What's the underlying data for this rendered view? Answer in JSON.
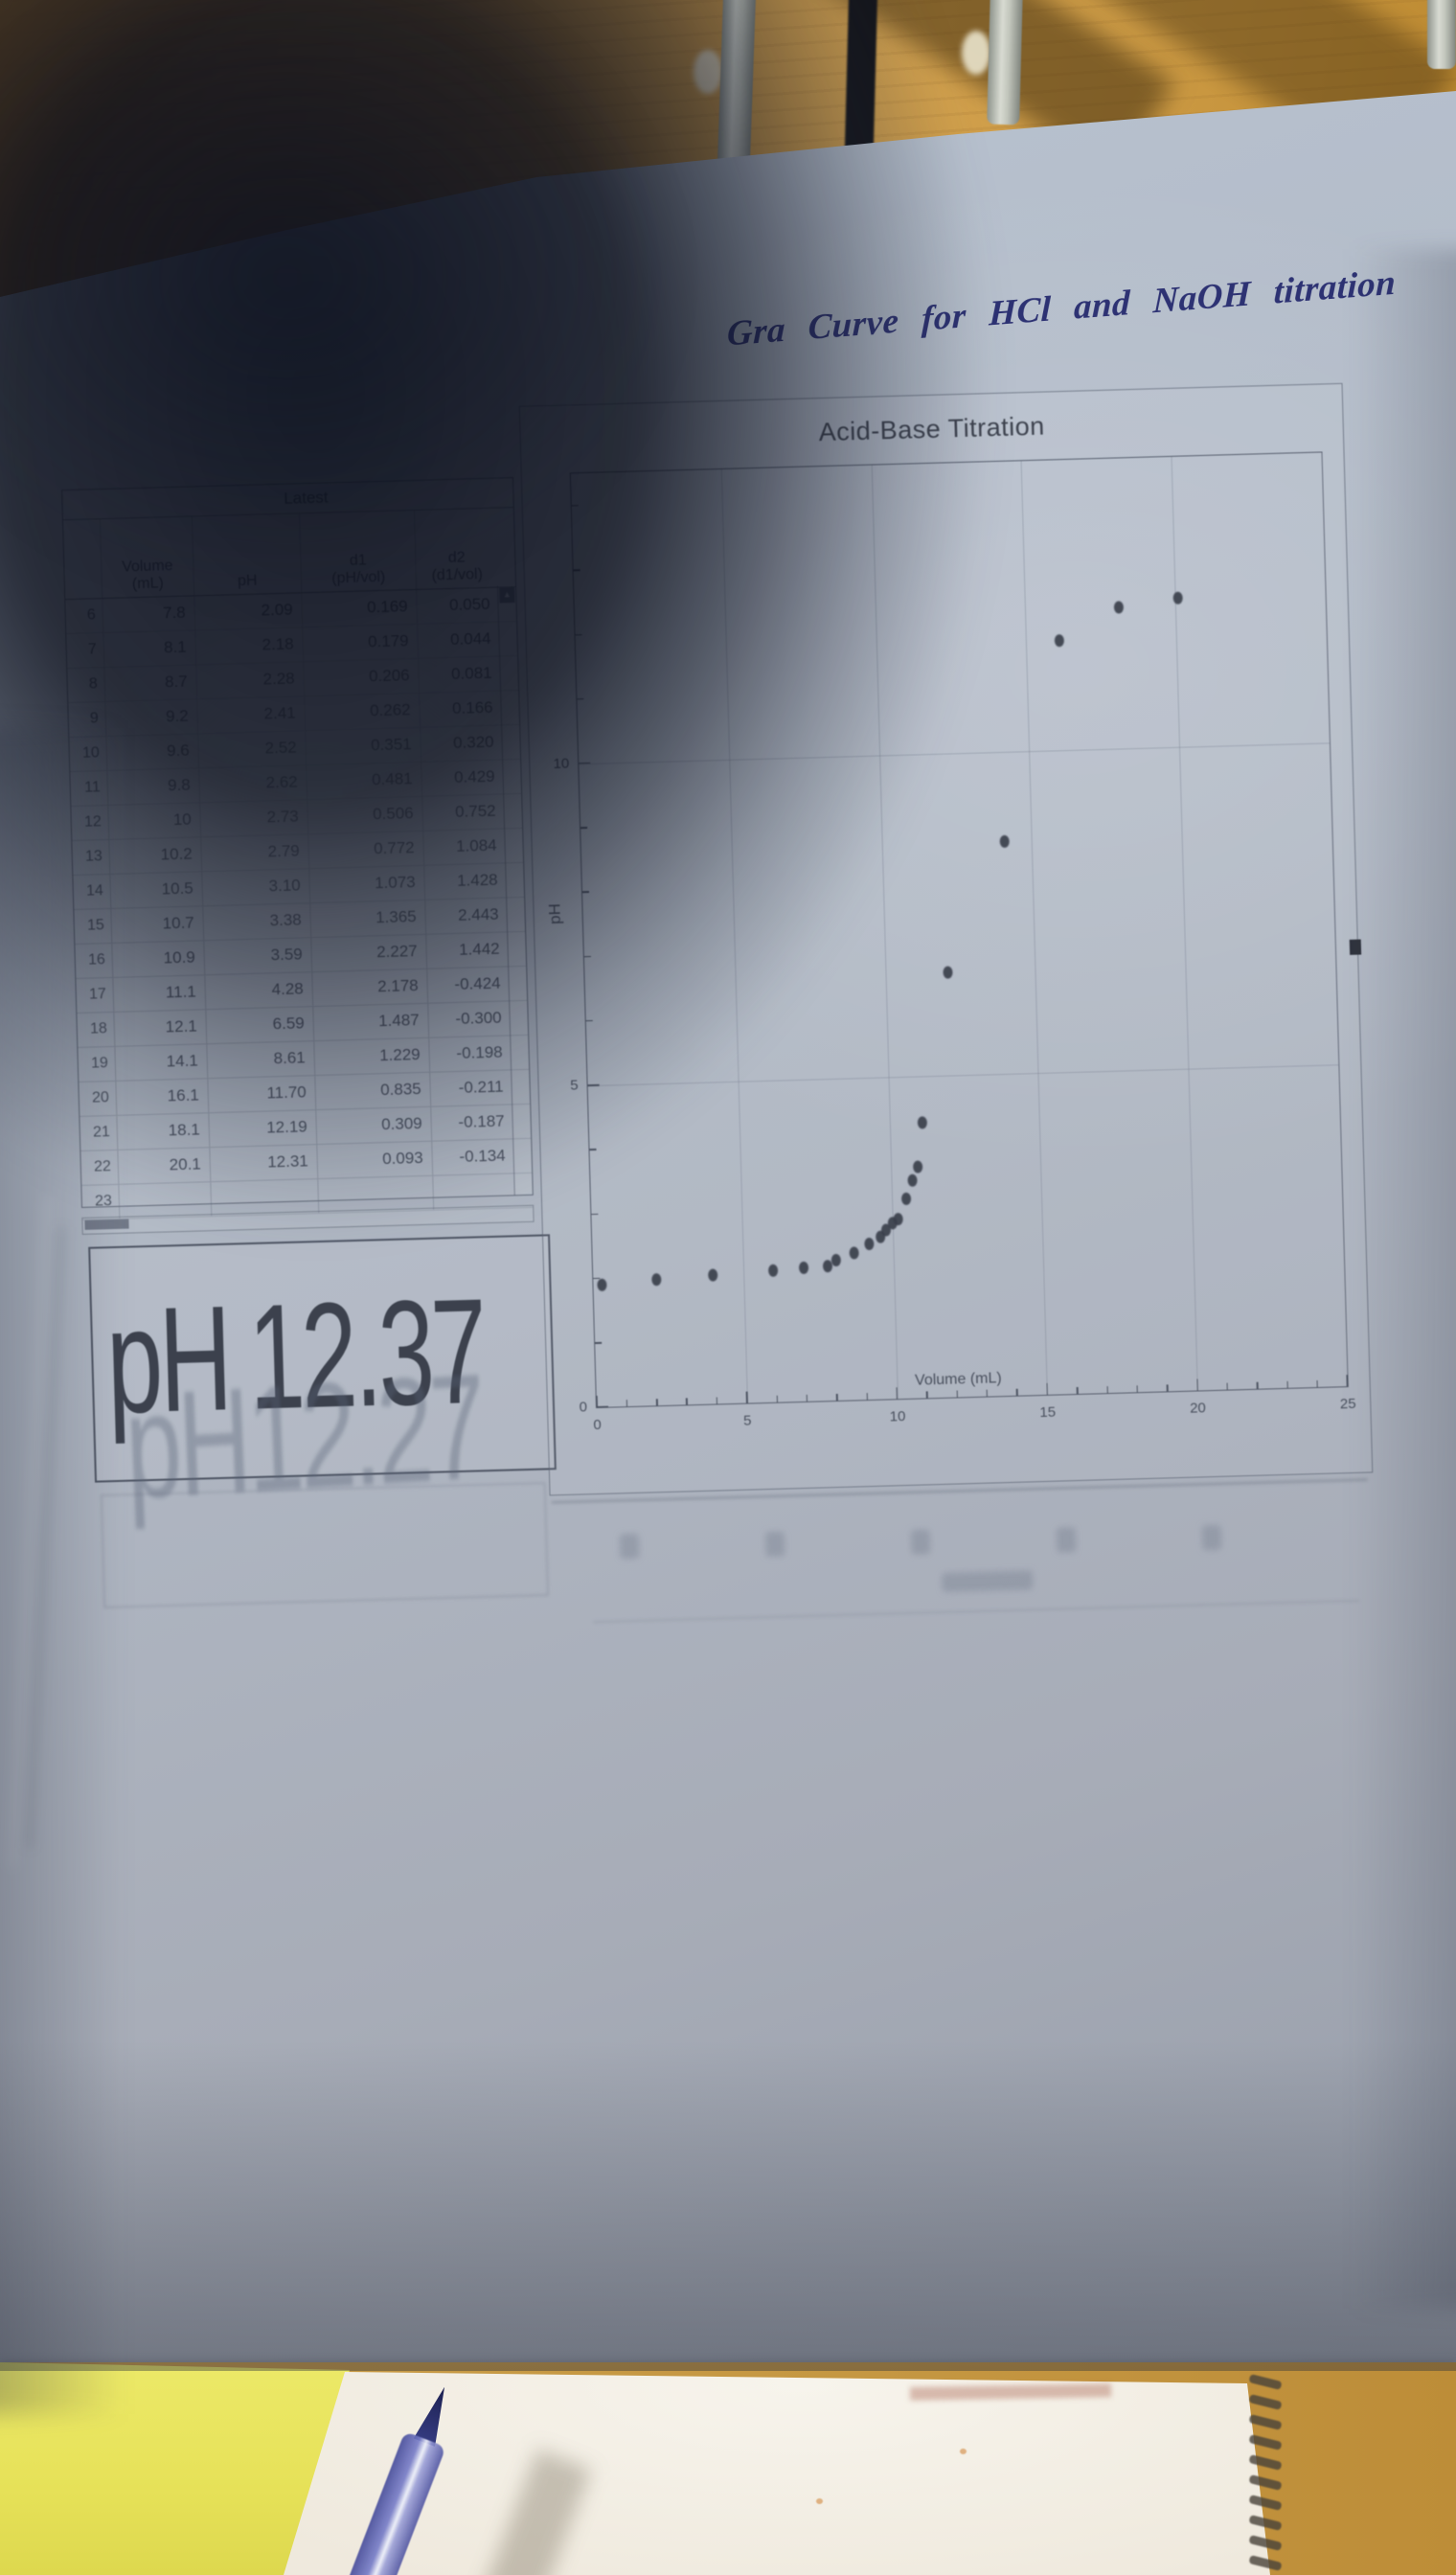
{
  "photo": {
    "handwritten_title": "Gra Curve for HCl and NaOH titration",
    "scene_items": [
      "wooden desk",
      "metal rack rods",
      "printed LoggerPro page in shadow",
      "spiral notebook page",
      "blue pen"
    ],
    "colors": {
      "paper": "#b0b9c5",
      "paper_shadow": "#5f6a7c",
      "wood_desk": "#c99a47",
      "desk_yellow": "#e9e45c",
      "notebook_page": "#f2efe6",
      "pen_blue": "#3c4290",
      "ink_blue": "#2d3273",
      "print_gray": "#454c59"
    }
  },
  "table": {
    "dataset_label": "Latest",
    "columns": [
      {
        "line1": "Volume",
        "line2": "(mL)"
      },
      {
        "line1": "pH",
        "line2": ""
      },
      {
        "line1": "d1",
        "line2": "(pH/vol)"
      },
      {
        "line1": "d2",
        "line2": "(d1/vol)"
      }
    ],
    "rows": [
      {
        "n": "6",
        "vol": "7.8",
        "ph": "2.09",
        "d1": "0.169",
        "d2": "0.050"
      },
      {
        "n": "7",
        "vol": "8.1",
        "ph": "2.18",
        "d1": "0.179",
        "d2": "0.044"
      },
      {
        "n": "8",
        "vol": "8.7",
        "ph": "2.28",
        "d1": "0.206",
        "d2": "0.081"
      },
      {
        "n": "9",
        "vol": "9.2",
        "ph": "2.41",
        "d1": "0.262",
        "d2": "0.166"
      },
      {
        "n": "10",
        "vol": "9.6",
        "ph": "2.52",
        "d1": "0.351",
        "d2": "0.320"
      },
      {
        "n": "11",
        "vol": "9.8",
        "ph": "2.62",
        "d1": "0.481",
        "d2": "0.429"
      },
      {
        "n": "12",
        "vol": "10",
        "ph": "2.73",
        "d1": "0.506",
        "d2": "0.752"
      },
      {
        "n": "13",
        "vol": "10.2",
        "ph": "2.79",
        "d1": "0.772",
        "d2": "1.084"
      },
      {
        "n": "14",
        "vol": "10.5",
        "ph": "3.10",
        "d1": "1.073",
        "d2": "1.428"
      },
      {
        "n": "15",
        "vol": "10.7",
        "ph": "3.38",
        "d1": "1.365",
        "d2": "2.443"
      },
      {
        "n": "16",
        "vol": "10.9",
        "ph": "3.59",
        "d1": "2.227",
        "d2": "1.442"
      },
      {
        "n": "17",
        "vol": "11.1",
        "ph": "4.28",
        "d1": "2.178",
        "d2": "-0.424"
      },
      {
        "n": "18",
        "vol": "12.1",
        "ph": "6.59",
        "d1": "1.487",
        "d2": "-0.300"
      },
      {
        "n": "19",
        "vol": "14.1",
        "ph": "8.61",
        "d1": "1.229",
        "d2": "-0.198"
      },
      {
        "n": "20",
        "vol": "16.1",
        "ph": "11.70",
        "d1": "0.835",
        "d2": "-0.211"
      },
      {
        "n": "21",
        "vol": "18.1",
        "ph": "12.19",
        "d1": "0.309",
        "d2": "-0.187"
      },
      {
        "n": "22",
        "vol": "20.1",
        "ph": "12.31",
        "d1": "0.093",
        "d2": "-0.134"
      },
      {
        "n": "23",
        "vol": "",
        "ph": "",
        "d1": "",
        "d2": ""
      }
    ]
  },
  "meter": {
    "label": "pH",
    "value": "12.37",
    "ghost_label": "pH",
    "ghost_value": "12.27"
  },
  "chart_data": {
    "type": "scatter",
    "title": "Acid-Base Titration",
    "xlabel": "Volume (mL)",
    "ylabel": "pH",
    "xlim": [
      0,
      25
    ],
    "ylim": [
      0,
      14.5
    ],
    "x_major_ticks": [
      0,
      5,
      10,
      15,
      20,
      25
    ],
    "x_minor_tick_step": 1,
    "y_major_ticks": [
      0,
      5,
      10
    ],
    "y_minor_tick_step": 1,
    "grid": true,
    "series": [
      {
        "name": "pH vs Volume",
        "marker": "dot",
        "points": [
          [
            0.3,
            1.9
          ],
          [
            2.1,
            1.95
          ],
          [
            4.0,
            2.0
          ],
          [
            6.0,
            2.05
          ],
          [
            7.0,
            2.07
          ],
          [
            7.8,
            2.09
          ],
          [
            8.1,
            2.18
          ],
          [
            8.7,
            2.28
          ],
          [
            9.2,
            2.41
          ],
          [
            9.6,
            2.52
          ],
          [
            9.8,
            2.62
          ],
          [
            10.0,
            2.73
          ],
          [
            10.2,
            2.79
          ],
          [
            10.5,
            3.1
          ],
          [
            10.7,
            3.38
          ],
          [
            10.9,
            3.59
          ],
          [
            11.1,
            4.28
          ],
          [
            12.1,
            6.59
          ],
          [
            14.1,
            8.61
          ],
          [
            16.1,
            11.7
          ],
          [
            18.1,
            12.19
          ],
          [
            20.1,
            12.31
          ]
        ]
      }
    ]
  }
}
